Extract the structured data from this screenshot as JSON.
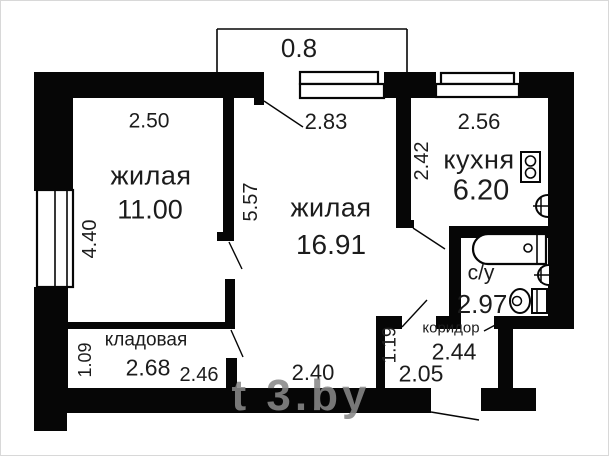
{
  "plan": {
    "title": "apartment-floor-plan",
    "watermark": "t 3.by",
    "balcony_dim": "0.8",
    "colors": {
      "wall": "#060606",
      "text": "#1c1c1c",
      "watermark": "#878787"
    },
    "rooms": [
      {
        "id": "living-1",
        "name": "жилая",
        "area": "11.00",
        "width_dim": "2.50",
        "height_dim": "4.40"
      },
      {
        "id": "living-2",
        "name": "жилая",
        "area": "16.91",
        "top_dim": "2.83",
        "height_dim": "5.57",
        "bottom_dim": "2.40"
      },
      {
        "id": "kitchen",
        "name": "кухня",
        "area": "6.20",
        "width_dim": "2.56",
        "height_dim": "2.42"
      },
      {
        "id": "bathroom",
        "name": "с/у",
        "area": "2.97"
      },
      {
        "id": "corridor",
        "name": "коридор",
        "area": "2.44",
        "width_dim": "2.05",
        "height_dim": "1.19"
      },
      {
        "id": "storage",
        "name": "кладовая",
        "area": "2.68",
        "height_dim": "1.09",
        "door_dim": "2.46"
      }
    ]
  }
}
